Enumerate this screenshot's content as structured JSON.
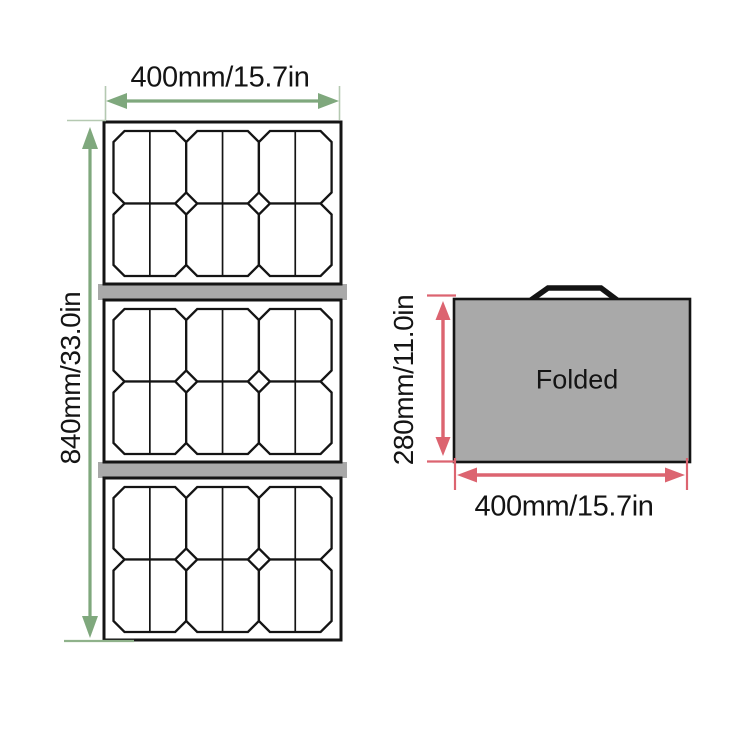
{
  "title": "Foldable solar panel dimensions diagram",
  "unfolded": {
    "width_label": "400mm/15.7in",
    "height_label": "840mm/33.0in",
    "sections": 3,
    "cells_per_section": {
      "rows": 2,
      "cols": 3
    }
  },
  "folded": {
    "name_label": "Folded",
    "height_label": "280mm/11.0in",
    "width_label": "400mm/15.7in"
  },
  "colors": {
    "dimension_green": "#7fa87d",
    "dimension_green_light": "#b5c9b1",
    "dimension_red": "#dc6470",
    "panel_gray": "#a9a9a9",
    "line_black": "#141414",
    "background": "#ffffff"
  }
}
